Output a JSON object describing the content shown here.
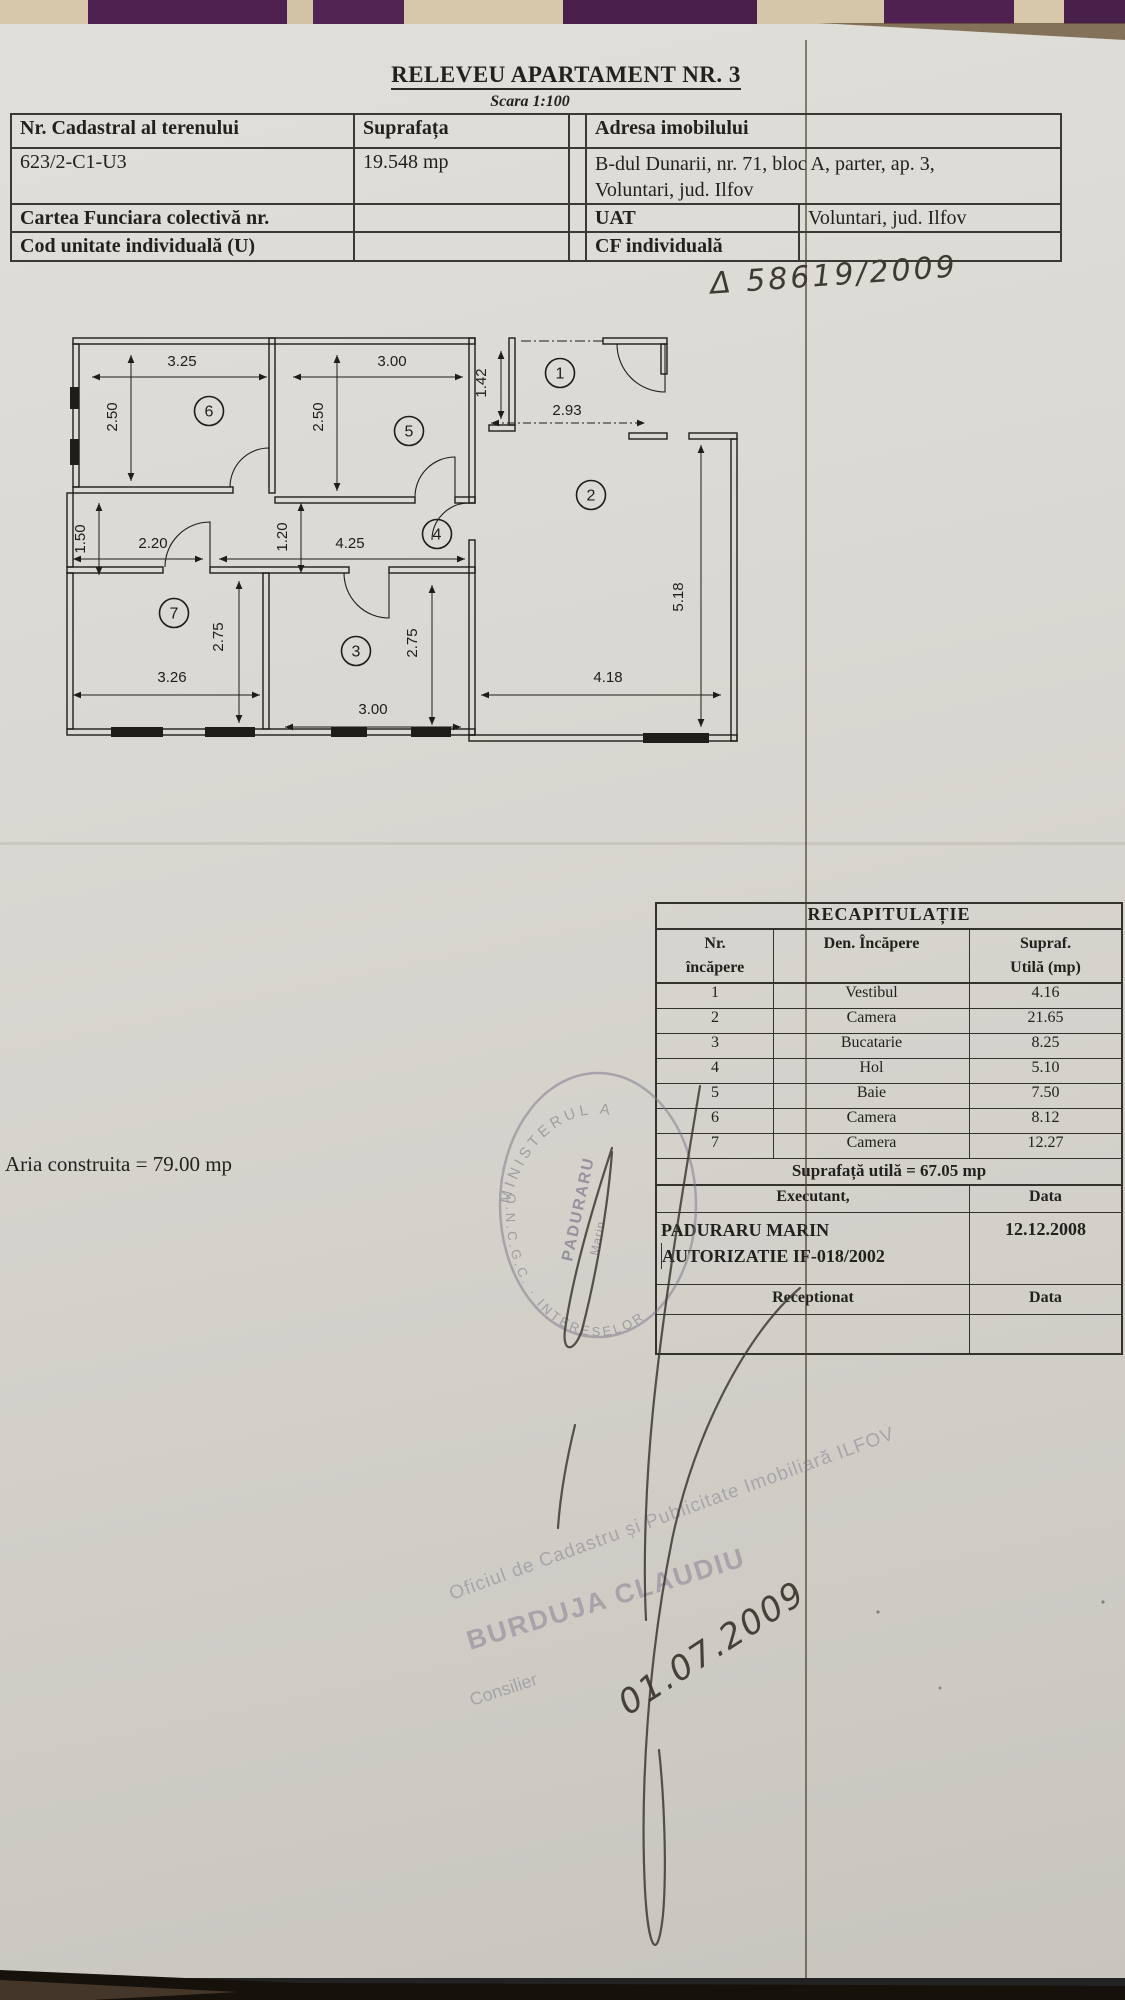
{
  "document": {
    "title": "RELEVEU APARTAMENT NR. 3",
    "scale_note": "Scara 1:100",
    "handwritten_ref": "Δ 58619/2009",
    "aria_construita": "Aria construita = 79.00 mp"
  },
  "info_table": {
    "cadastral_label": "Nr. Cadastral al terenului",
    "suprafata_label": "Suprafața",
    "cadastral_value": "623/2-C1-U3",
    "suprafata_value": "19.548 mp",
    "carte_funciara_label": "Cartea Funciara colectivă nr.",
    "cod_unitate_label": "Cod unitate individuală (U)",
    "adresa_label": "Adresa imobilului",
    "adresa_line1": "B-dul Dunarii, nr. 71, bloc A, parter, ap. 3,",
    "adresa_line2": "Voluntari, jud. Ilfov",
    "uat_label": "UAT",
    "uat_value": "Voluntari, jud. Ilfov",
    "cf_label": "CF individuală"
  },
  "floor_plan": {
    "rooms": [
      {
        "n": "1",
        "cx": 505,
        "cy": 48
      },
      {
        "n": "2",
        "cx": 536,
        "cy": 170
      },
      {
        "n": "3",
        "cx": 301,
        "cy": 326
      },
      {
        "n": "4",
        "cx": 382,
        "cy": 209
      },
      {
        "n": "5",
        "cx": 354,
        "cy": 106
      },
      {
        "n": "6",
        "cx": 154,
        "cy": 86
      },
      {
        "n": "7",
        "cx": 119,
        "cy": 288
      }
    ],
    "dims_h": [
      {
        "label": "3.25",
        "tx": 127,
        "ty": 41,
        "y": 52,
        "x1": 37,
        "x2": 212
      },
      {
        "label": "3.00",
        "tx": 337,
        "ty": 41,
        "y": 52,
        "x1": 238,
        "x2": 408
      },
      {
        "label": "2.93",
        "tx": 512,
        "ty": 90,
        "y": 98,
        "x1": 436,
        "x2": 590,
        "dash": true
      },
      {
        "label": "2.20",
        "tx": 98,
        "ty": 223,
        "y": 234,
        "x1": 18,
        "x2": 148
      },
      {
        "label": "4.25",
        "tx": 295,
        "ty": 223,
        "y": 234,
        "x1": 164,
        "x2": 410
      },
      {
        "label": "3.26",
        "tx": 117,
        "ty": 357,
        "y": 370,
        "x1": 18,
        "x2": 205
      },
      {
        "label": "3.00",
        "tx": 318,
        "ty": 389,
        "y": 402,
        "x1": 230,
        "x2": 406
      },
      {
        "label": "4.18",
        "tx": 553,
        "ty": 357,
        "y": 370,
        "x1": 426,
        "x2": 666
      }
    ],
    "dims_v": [
      {
        "label": "2.50",
        "tx": 62,
        "ty": 92,
        "x": 76,
        "y1": 30,
        "y2": 156
      },
      {
        "label": "2.50",
        "tx": 268,
        "ty": 92,
        "x": 282,
        "y1": 30,
        "y2": 166
      },
      {
        "label": "1.42",
        "tx": 431,
        "ty": 58,
        "x": 446,
        "y1": 26,
        "y2": 94
      },
      {
        "label": "1.50",
        "tx": 30,
        "ty": 214,
        "x": 44,
        "y1": 178,
        "y2": 250
      },
      {
        "label": "1.20",
        "tx": 232,
        "ty": 212,
        "x": 246,
        "y1": 178,
        "y2": 248
      },
      {
        "label": "2.75",
        "tx": 168,
        "ty": 312,
        "x": 184,
        "y1": 256,
        "y2": 398
      },
      {
        "label": "2.75",
        "tx": 362,
        "ty": 318,
        "x": 377,
        "y1": 260,
        "y2": 400
      },
      {
        "label": "5.18",
        "tx": 628,
        "ty": 272,
        "x": 646,
        "y1": 120,
        "y2": 402
      }
    ]
  },
  "recap": {
    "title": "RECAPITULAȚIE",
    "col1": "Nr.\nîncăpere",
    "col2": "Den.  Încăpere",
    "col3": "Supraf.\nUtilă (mp)",
    "rows": [
      [
        "1",
        "Vestibul",
        "4.16"
      ],
      [
        "2",
        "Camera",
        "21.65"
      ],
      [
        "3",
        "Bucatarie",
        "8.25"
      ],
      [
        "4",
        "Hol",
        "5.10"
      ],
      [
        "5",
        "Baie",
        "7.50"
      ],
      [
        "6",
        "Camera",
        "8.12"
      ],
      [
        "7",
        "Camera",
        "12.27"
      ]
    ],
    "total": "Suprafață utilă = 67.05 mp",
    "executant_label": "Executant,",
    "data_label": "Data",
    "executant_name": "PADURARU MARIN",
    "executant_auth": "AUTORIZATIE IF-018/2002",
    "executant_date": "12.12.2008",
    "receptionat_label": "Receptionat",
    "receptionat_data_label": "Data"
  },
  "stamps": {
    "round_top": "MINISTERUL  A",
    "round_bottom": "O.N.C.G.C. · INTERESELOR",
    "round_inner1": "PADURARU",
    "round_inner2": "Marin",
    "diag_line1": "Oficiul de Cadastru și Publicitate Imobiliară ILFOV",
    "diag_line2": "BURDUJA CLAUDIU",
    "diag_line3": "Consilier",
    "date_handwritten": "01.07.2009"
  }
}
